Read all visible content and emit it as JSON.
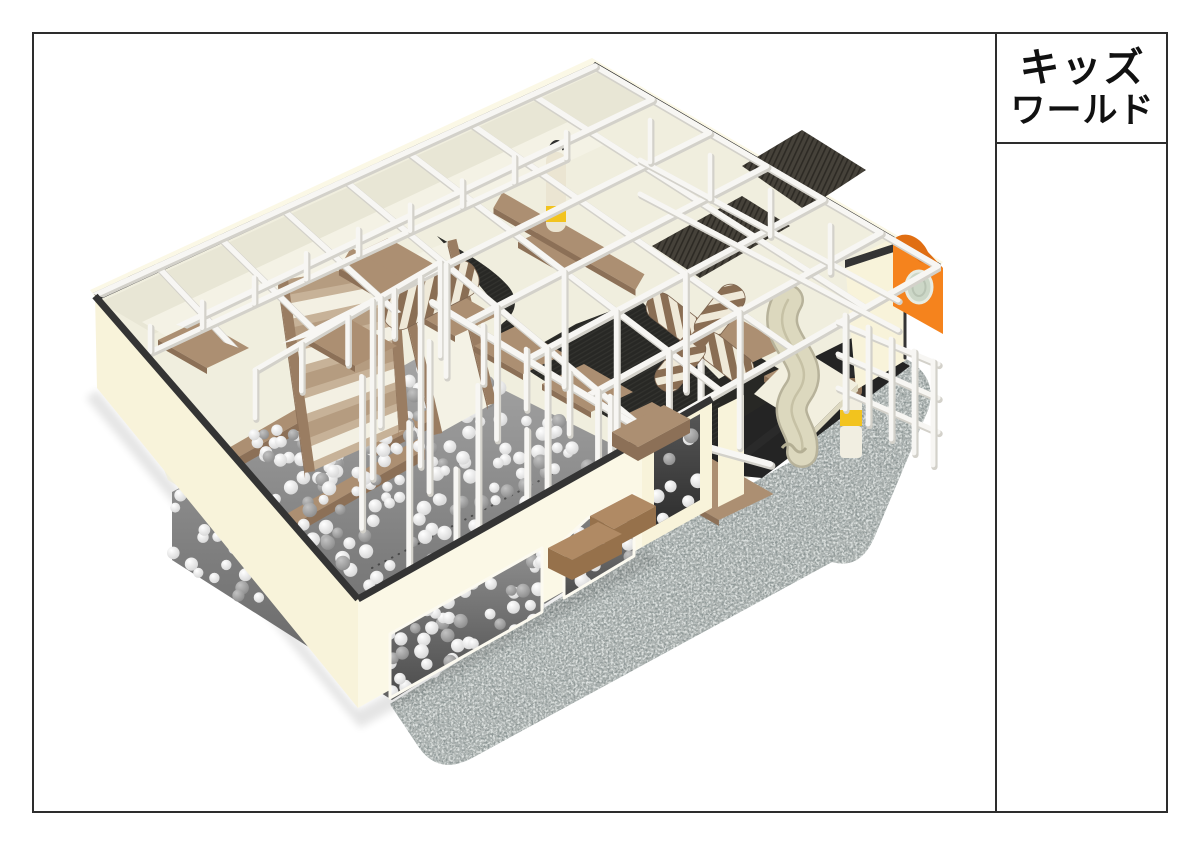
{
  "sheet": {
    "background_color": "#ffffff",
    "border_color": "#2d2d2d",
    "title_block": {
      "line1": "キッズ",
      "line2": "ワールド"
    }
  },
  "render": {
    "subject": "3D isometric rendering of an indoor kids playground structure",
    "colors": {
      "frame_white": "#f7f6f3",
      "frame_shadow": "#d3d1ca",
      "wall_cream": "#f8f3da",
      "wall_cream_light": "#fbf8e6",
      "trim_dark": "#343434",
      "trim_darker": "#292929",
      "floor_cream": "#f0eede",
      "floor_back": "#e8e6d5",
      "walkway": "#f4f2e5",
      "pad_top": "#ac8f72",
      "pad_side": "#8c7057",
      "tramp_black": "#282825",
      "tramp_line": "#3a3a36",
      "net_dark": "#46423a",
      "net_line": "#2d2a24",
      "pit_light": "#a8a8a8",
      "pit_dark": "#696969",
      "ball_white": "#f5f5f5",
      "ball_gray": "#9e9e9e",
      "stair_rail": "#9a7d62",
      "stair_base": "#c7b298",
      "roller_white": "#f3f0e3",
      "carpet_base": "#a8b1b0",
      "carpet_speck_light": "#eef1ef",
      "carpet_speck_dark": "#64706f",
      "slide_beige": "#dcd8be",
      "slide_edge": "#b7b29a",
      "mat_cream": "#f2efdf",
      "accent_orange": "#f5831d",
      "porthole": "#ccd7c7",
      "accent_yellow": "#f2c31e"
    }
  }
}
